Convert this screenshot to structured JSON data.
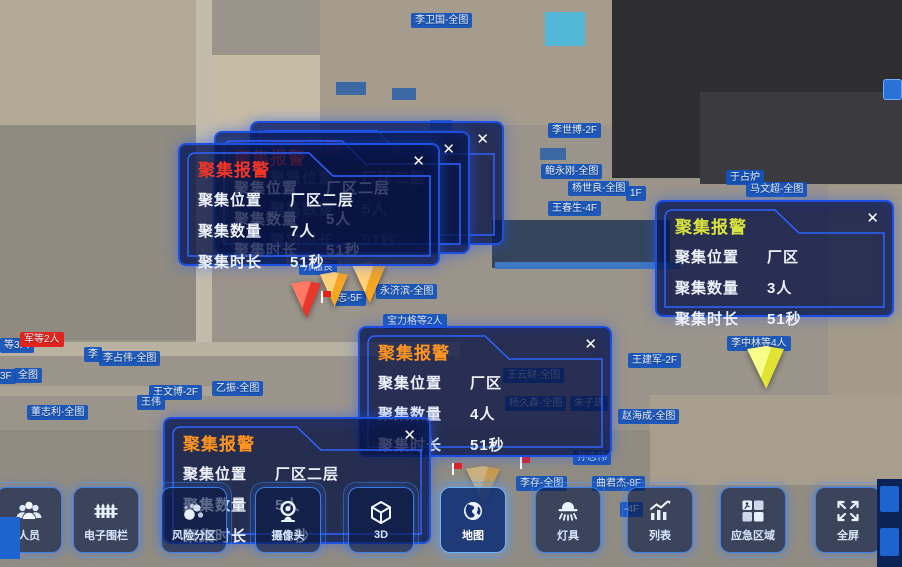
{
  "ui": {
    "close_glyph": "✕"
  },
  "colors": {
    "popup_border": "#1d50e0",
    "alarm_title_red": "#f03527",
    "alarm_title_yellow": "#d8e23c",
    "alarm_title_orange": "#ff9421",
    "label_blue": "#1252bc",
    "label_red": "#e5231d"
  },
  "popups": [
    {
      "id": "alarm-stack-back",
      "x": 250,
      "y": 121,
      "w": 250,
      "h": 120,
      "z": 51,
      "title": "聚集报警",
      "title_color": "#f03527",
      "rows": [
        [
          "聚集位置",
          "厂区二层"
        ],
        [
          "聚集数量",
          "5人"
        ],
        [
          "聚集时长",
          "51秒"
        ]
      ]
    },
    {
      "id": "alarm-stack-mid",
      "x": 214,
      "y": 131,
      "w": 252,
      "h": 119,
      "z": 52,
      "title": "聚集报警",
      "title_color": "#f03527",
      "rows": [
        [
          "聚集位置",
          "厂区二层"
        ],
        [
          "聚集数量",
          "5人"
        ],
        [
          "聚集时长",
          "51秒"
        ]
      ]
    },
    {
      "id": "alarm-front-left",
      "x": 178,
      "y": 143,
      "w": 258,
      "h": 119,
      "z": 53,
      "title": "聚集报警",
      "title_color": "#f03527",
      "rows": [
        [
          "聚集位置",
          "厂区二层"
        ],
        [
          "聚集数量",
          "7人"
        ],
        [
          "聚集时长",
          "51秒"
        ]
      ]
    },
    {
      "id": "alarm-right",
      "x": 655,
      "y": 200,
      "w": 235,
      "h": 113,
      "z": 54,
      "title": "聚集报警",
      "title_color": "#d8e23c",
      "rows": [
        [
          "聚集位置",
          "厂区"
        ],
        [
          "聚集数量",
          "3人"
        ],
        [
          "聚集时长",
          "51秒"
        ]
      ]
    },
    {
      "id": "alarm-middle",
      "x": 358,
      "y": 326,
      "w": 250,
      "h": 127,
      "z": 54,
      "title": "聚集报警",
      "title_color": "#ff9421",
      "rows": [
        [
          "聚集位置",
          "厂区"
        ],
        [
          "聚集数量",
          "4人"
        ],
        [
          "聚集时长",
          "51秒"
        ]
      ]
    },
    {
      "id": "alarm-bottom",
      "x": 163,
      "y": 417,
      "w": 264,
      "h": 123,
      "z": 55,
      "title": "聚集报警",
      "title_color": "#ff9421",
      "rows": [
        [
          "聚集位置",
          "厂区二层"
        ],
        [
          "聚集数量",
          "5人"
        ],
        [
          "聚集时长",
          "51秒"
        ]
      ]
    }
  ],
  "toolbar": {
    "buttons": [
      {
        "label": "人员",
        "icon": "people-icon",
        "cx": 28,
        "active": false
      },
      {
        "label": "电子围栏",
        "icon": "fence-icon",
        "cx": 105,
        "active": false
      },
      {
        "label": "风险分区",
        "icon": "bubbles-icon",
        "cx": 193,
        "active": false
      },
      {
        "label": "摄像头",
        "icon": "camera-icon",
        "cx": 287,
        "active": false
      },
      {
        "label": "3D",
        "icon": "cube-3d-icon",
        "cx": 380,
        "active": false
      },
      {
        "label": "地图",
        "icon": "globe-icon",
        "cx": 472,
        "active": true
      },
      {
        "label": "灯具",
        "icon": "lamp-icon",
        "cx": 567,
        "active": false
      },
      {
        "label": "列表",
        "icon": "chart-icon",
        "cx": 659,
        "active": false
      },
      {
        "label": "应急区域",
        "icon": "emergency-icon",
        "cx": 752,
        "active": false
      },
      {
        "label": "全屏",
        "icon": "fullscreen-icon",
        "cx": 847,
        "active": false
      }
    ]
  },
  "map_labels": [
    {
      "text": "李卫国-全图",
      "x": 411,
      "y": 13
    },
    {
      "text": "李世博-2F",
      "x": 548,
      "y": 123
    },
    {
      "text": "鲍永刚-全图",
      "x": 541,
      "y": 164
    },
    {
      "text": "杨世良-全图",
      "x": 568,
      "y": 181
    },
    {
      "text": "1F",
      "x": 626,
      "y": 186
    },
    {
      "text": "王春生-4F",
      "x": 548,
      "y": 201
    },
    {
      "text": "于占炉",
      "x": 726,
      "y": 170
    },
    {
      "text": "马文超-全图",
      "x": 746,
      "y": 182
    },
    {
      "text": "齐温良",
      "x": 299,
      "y": 260
    },
    {
      "text": "永济滨-全图",
      "x": 376,
      "y": 284
    },
    {
      "text": "志-5F",
      "x": 333,
      "y": 291
    },
    {
      "text": "宝力格等2人",
      "x": 383,
      "y": 314
    },
    {
      "text": "等3人",
      "x": 0,
      "y": 338
    },
    {
      "text": "军等2人",
      "x": 20,
      "y": 332,
      "variant": "red"
    },
    {
      "text": "李",
      "x": 84,
      "y": 347
    },
    {
      "text": "李占伟-全图",
      "x": 99,
      "y": 351
    },
    {
      "text": "3F",
      "x": -4,
      "y": 369
    },
    {
      "text": "全图",
      "x": 14,
      "y": 368
    },
    {
      "text": "王文博-2F",
      "x": 149,
      "y": 385
    },
    {
      "text": "乙振-全图",
      "x": 212,
      "y": 381
    },
    {
      "text": "王伟",
      "x": 137,
      "y": 395
    },
    {
      "text": "董志利-全图",
      "x": 27,
      "y": 405
    },
    {
      "text": "王建军-2F",
      "x": 628,
      "y": 353
    },
    {
      "text": "李中林等4人",
      "x": 727,
      "y": 336
    },
    {
      "text": "王云财-全图",
      "x": 503,
      "y": 368
    },
    {
      "text": "杨久森-全图",
      "x": 505,
      "y": 396
    },
    {
      "text": "朱子建",
      "x": 570,
      "y": 396
    },
    {
      "text": "赵海成-全图",
      "x": 618,
      "y": 409
    },
    {
      "text": "孙志伟",
      "x": 573,
      "y": 450
    },
    {
      "text": "李存-全图",
      "x": 516,
      "y": 476
    },
    {
      "text": "曲君杰-8F",
      "x": 592,
      "y": 476
    },
    {
      "text": "-4F",
      "x": 620,
      "y": 502
    }
  ],
  "markers": [
    {
      "name": "alarm-pyramid-red",
      "x": 291,
      "y": 281,
      "w": 30,
      "h": 37,
      "light": "#ff7a66",
      "dark": "#e8372b",
      "faded": false
    },
    {
      "name": "alarm-pyramid-orange",
      "x": 320,
      "y": 272,
      "w": 28,
      "h": 35,
      "light": "#ffd27a",
      "dark": "#f5a623",
      "faded": false
    },
    {
      "name": "alarm-pyramid-orange",
      "x": 352,
      "y": 262,
      "w": 34,
      "h": 41,
      "light": "#ffd27a",
      "dark": "#f5a623",
      "faded": false
    },
    {
      "name": "alarm-pyramid-yellow",
      "x": 747,
      "y": 346,
      "w": 37,
      "h": 43,
      "light": "#f7ff8a",
      "dark": "#e0e334",
      "faded": false
    },
    {
      "name": "alarm-pyramid-orange",
      "x": 466,
      "y": 466,
      "w": 34,
      "h": 40,
      "light": "#ffd27a",
      "dark": "#f5a623",
      "faded": true
    }
  ],
  "flags": [
    {
      "x": 321,
      "y": 291
    },
    {
      "x": 452,
      "y": 463
    },
    {
      "x": 520,
      "y": 457
    }
  ]
}
